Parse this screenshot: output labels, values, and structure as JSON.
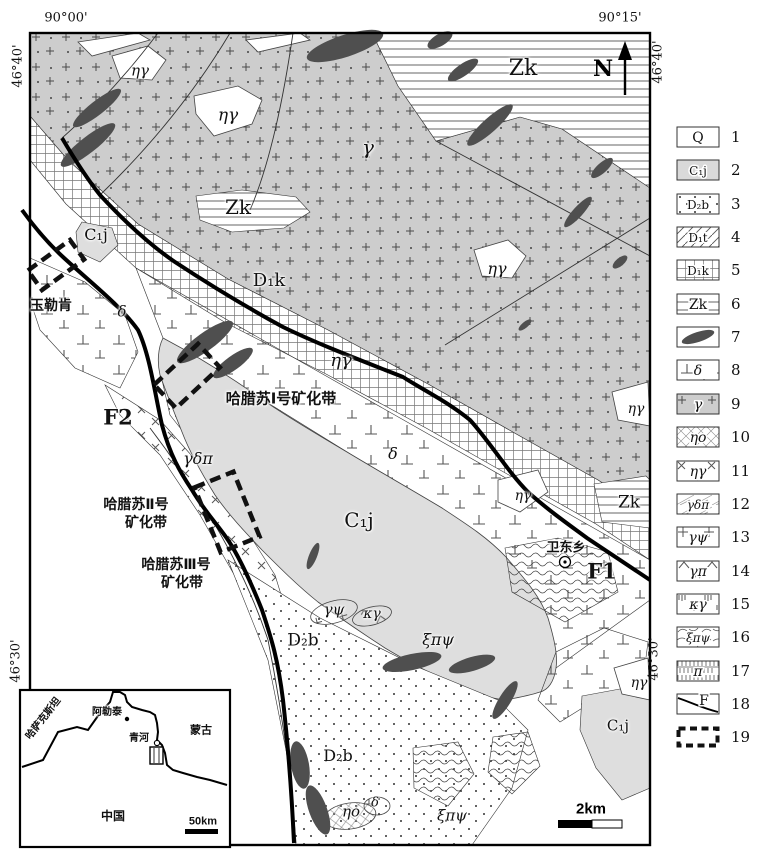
{
  "map": {
    "coords": {
      "top_left": "90°00'",
      "top_right": "90°15'",
      "left_top": "46°40'",
      "right_top": "46°40'",
      "left_bottom": "46°30'",
      "right_bottom": "46°30'"
    },
    "north_label": "N",
    "scale_label": "2km",
    "labels": [
      {
        "t": "ηγ",
        "x": 140,
        "y": 71,
        "fs": 15,
        "k": "g"
      },
      {
        "t": "ηγ",
        "x": 228,
        "y": 116,
        "fs": 17,
        "k": "g"
      },
      {
        "t": "γ",
        "x": 368,
        "y": 147,
        "fs": 20,
        "k": "g"
      },
      {
        "t": "Zk",
        "x": 523,
        "y": 69,
        "fs": 22,
        "k": "u"
      },
      {
        "t": "Zk",
        "x": 238,
        "y": 207,
        "fs": 20,
        "k": "u"
      },
      {
        "t": "C₁j",
        "x": 96,
        "y": 235,
        "fs": 16,
        "k": "u"
      },
      {
        "t": "D₁k",
        "x": 269,
        "y": 281,
        "fs": 18,
        "k": "u"
      },
      {
        "t": "玉勒肯",
        "x": 51,
        "y": 305,
        "fs": 14,
        "k": "c"
      },
      {
        "t": "δ",
        "x": 122,
        "y": 312,
        "fs": 15,
        "k": "g"
      },
      {
        "t": "ηγ",
        "x": 341,
        "y": 361,
        "fs": 18,
        "k": "g"
      },
      {
        "t": "F2",
        "x": 118,
        "y": 417,
        "fs": 21,
        "k": "f"
      },
      {
        "t": "哈腊苏Ⅰ号矿化带",
        "x": 281,
        "y": 399,
        "fs": 15,
        "k": "c"
      },
      {
        "t": "γδπ",
        "x": 198,
        "y": 459,
        "fs": 16,
        "k": "g"
      },
      {
        "t": "δ",
        "x": 393,
        "y": 454,
        "fs": 16,
        "k": "g"
      },
      {
        "t": "ηγ",
        "x": 497,
        "y": 269,
        "fs": 16,
        "k": "g"
      },
      {
        "t": "ηγ",
        "x": 636,
        "y": 409,
        "fs": 14,
        "k": "g"
      },
      {
        "t": "C₁j",
        "x": 359,
        "y": 520,
        "fs": 20,
        "k": "u"
      },
      {
        "t": "哈腊苏Ⅱ号",
        "x": 136,
        "y": 504,
        "fs": 14,
        "k": "c"
      },
      {
        "t": "矿化带",
        "x": 146,
        "y": 522,
        "fs": 14,
        "k": "c"
      },
      {
        "t": "哈腊苏Ⅲ号",
        "x": 176,
        "y": 564,
        "fs": 14,
        "k": "c"
      },
      {
        "t": "矿化带",
        "x": 182,
        "y": 582,
        "fs": 14,
        "k": "c"
      },
      {
        "t": "ηγ",
        "x": 523,
        "y": 496,
        "fs": 14,
        "k": "g"
      },
      {
        "t": "Zk",
        "x": 629,
        "y": 503,
        "fs": 17,
        "k": "u"
      },
      {
        "t": "卫东乡",
        "x": 566,
        "y": 547,
        "fs": 13,
        "k": "c"
      },
      {
        "t": "F1",
        "x": 602,
        "y": 571,
        "fs": 21,
        "k": "f"
      },
      {
        "t": "γψ",
        "x": 334,
        "y": 610,
        "fs": 15,
        "k": "g"
      },
      {
        "t": "κγ",
        "x": 372,
        "y": 614,
        "fs": 14,
        "k": "g"
      },
      {
        "t": "ξπψ",
        "x": 438,
        "y": 640,
        "fs": 16,
        "k": "g"
      },
      {
        "t": "D₂b",
        "x": 303,
        "y": 641,
        "fs": 17,
        "k": "u"
      },
      {
        "t": "ηγ",
        "x": 639,
        "y": 683,
        "fs": 14,
        "k": "g"
      },
      {
        "t": "C₁j",
        "x": 618,
        "y": 726,
        "fs": 15,
        "k": "u"
      },
      {
        "t": "D₂b",
        "x": 338,
        "y": 756,
        "fs": 16,
        "k": "u"
      },
      {
        "t": "ηo",
        "x": 351,
        "y": 812,
        "fs": 15,
        "k": "g"
      },
      {
        "t": "δ",
        "x": 375,
        "y": 803,
        "fs": 13,
        "k": "g"
      },
      {
        "t": "ξπψ",
        "x": 452,
        "y": 816,
        "fs": 15,
        "k": "g"
      }
    ],
    "inset": {
      "labels": [
        {
          "t": "哈萨克斯坦",
          "x": 44,
          "y": 719,
          "fs": 10,
          "k": "c",
          "rot": -52
        },
        {
          "t": "阿勒泰",
          "x": 107,
          "y": 713,
          "fs": 10,
          "k": "c"
        },
        {
          "t": "青河",
          "x": 139,
          "y": 739,
          "fs": 10,
          "k": "c"
        },
        {
          "t": "蒙古",
          "x": 201,
          "y": 731,
          "fs": 11,
          "k": "c"
        },
        {
          "t": "中国",
          "x": 113,
          "y": 816,
          "fs": 12,
          "k": "c"
        },
        {
          "t": "50km",
          "x": 203,
          "y": 822,
          "fs": 11,
          "k": "c"
        }
      ]
    }
  },
  "legend": {
    "items": [
      {
        "num": "1",
        "label": "Q",
        "swatch": "plain",
        "it": 0
      },
      {
        "num": "2",
        "label": "C₁j",
        "swatch": "gray",
        "it": 0
      },
      {
        "num": "3",
        "label": "D₂b",
        "swatch": "dots",
        "it": 0
      },
      {
        "num": "4",
        "label": "D₁t",
        "swatch": "diag",
        "it": 0
      },
      {
        "num": "5",
        "label": "D₁k",
        "swatch": "grid",
        "it": 0
      },
      {
        "num": "6",
        "label": "Zk",
        "swatch": "hlines",
        "it": 0
      },
      {
        "num": "7",
        "label": "",
        "swatch": "lens",
        "it": 0
      },
      {
        "num": "8",
        "label": "δ",
        "swatch": "perp",
        "it": 1
      },
      {
        "num": "9",
        "label": "γ",
        "swatch": "granite",
        "it": 1
      },
      {
        "num": "10",
        "label": "ηo",
        "swatch": "xhatch",
        "it": 1
      },
      {
        "num": "11",
        "label": "ηγ",
        "swatch": "xplus",
        "it": 1
      },
      {
        "num": "12",
        "label": "γδπ",
        "swatch": "thindiag",
        "it": 1
      },
      {
        "num": "13",
        "label": "γψ",
        "swatch": "plus",
        "it": 1
      },
      {
        "num": "14",
        "label": "γπ",
        "swatch": "caret",
        "it": 1
      },
      {
        "num": "15",
        "label": "κγ",
        "swatch": "vee",
        "it": 1
      },
      {
        "num": "16",
        "label": "ξπψ",
        "swatch": "cells",
        "it": 1
      },
      {
        "num": "17",
        "label": "π",
        "swatch": "vbrick",
        "it": 1
      },
      {
        "num": "18",
        "label": "F",
        "swatch": "fault",
        "it": 0
      },
      {
        "num": "19",
        "label": "",
        "swatch": "dashed",
        "it": 0
      }
    ]
  },
  "colors": {
    "granite_gray": "#cdcdcd",
    "unit_gray": "#dedede",
    "dark_lens": "#4f4f4f",
    "line": "#000000"
  }
}
